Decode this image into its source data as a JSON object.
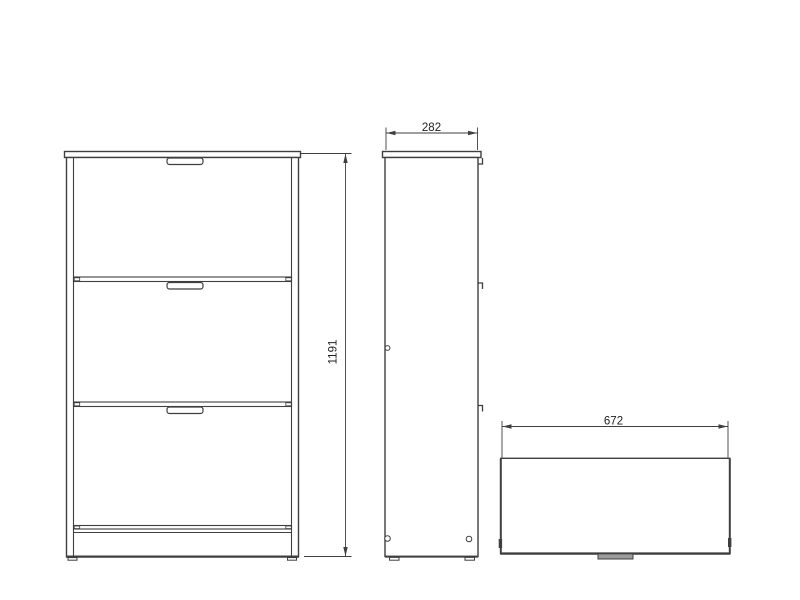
{
  "drawing": {
    "subject": "orthographic technical drawing of a three-drawer shoe cabinet (front, side, top views)",
    "background_color": "#ffffff",
    "line_color": "#3f3f3f",
    "dimensions": {
      "height": "1191",
      "depth": "282",
      "width": "672"
    }
  }
}
